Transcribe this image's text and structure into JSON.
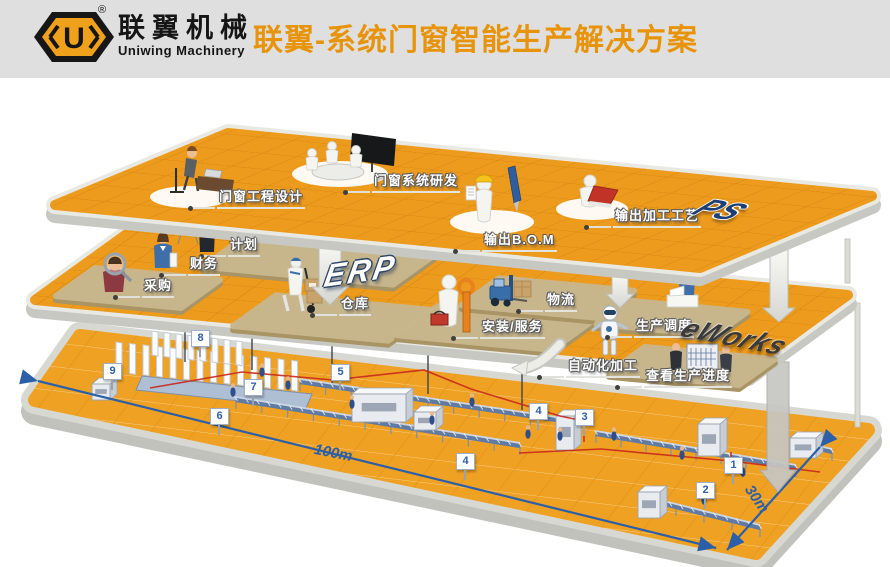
{
  "header": {
    "logo_cn": "联翼机械",
    "logo_en": "Uniwing Machinery",
    "logo_mark": "U",
    "registered_mark": "®",
    "title": "联翼-系统门窗智能生产解决方案"
  },
  "layers": {
    "design": {
      "system_label": "PS",
      "labels": {
        "eng_design": "门窗工程设计",
        "sys_rd": "门窗系统研发",
        "bom": "输出B.O.M",
        "process": "输出加工工艺"
      }
    },
    "erp": {
      "system_label": "ERP",
      "mes_label": "eWorks",
      "labels": {
        "plan": "计划",
        "finance": "财务",
        "purchase": "采购",
        "warehouse": "仓库",
        "logistics": "物流",
        "install": "安装/服务",
        "dispatch": "生产调度",
        "auto": "自动化加工",
        "progress": "查看生产进度"
      }
    },
    "floor": {
      "dimensions": {
        "length": "100m",
        "width": "30m"
      },
      "markers": {
        "n1": "1",
        "n2": "2",
        "n3": "3",
        "n4a": "4",
        "n4b": "4",
        "n5": "5",
        "n6": "6",
        "n7": "7",
        "n8": "8",
        "n9": "9"
      }
    }
  },
  "colors": {
    "header_gray": "#DFDFDF",
    "title_orange": "#E8940A",
    "platform_orange": "#ED9B1C",
    "grid_line": "#CF7F0E",
    "pad_tan": "#C9B78E",
    "dimension_blue": "#2B5FA8",
    "ps_navy": "#1E3E74",
    "red_route": "#C8281C"
  }
}
